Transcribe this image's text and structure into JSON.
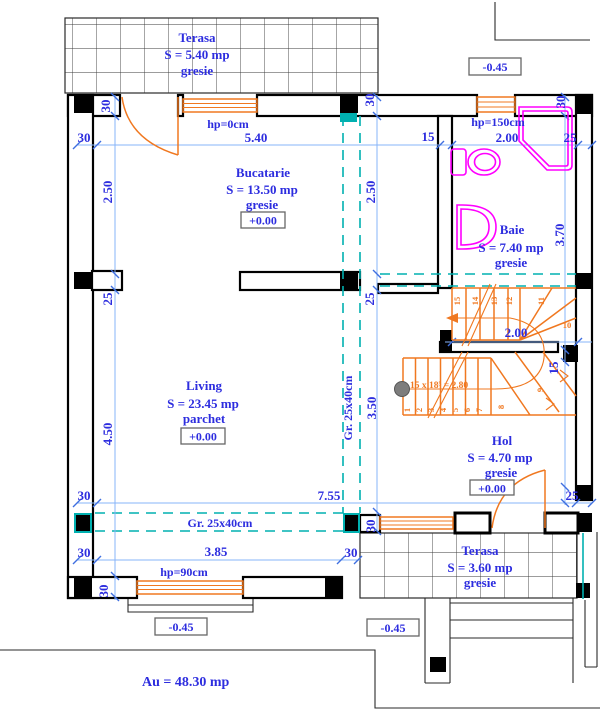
{
  "plan": {
    "rooms": {
      "terasa_top": {
        "name": "Terasa",
        "area": "S = 5.40 mp",
        "finish": "gresie"
      },
      "bucatarie": {
        "name": "Bucatarie",
        "area": "S = 13.50 mp",
        "finish": "gresie",
        "level": "+0.00"
      },
      "baie": {
        "name": "Baie",
        "area": "S = 7.40 mp",
        "finish": "gresie"
      },
      "living": {
        "name": "Living",
        "area": "S = 23.45 mp",
        "finish": "parchet",
        "level": "+0.00"
      },
      "hol": {
        "name": "Hol",
        "area": "S = 4.70 mp",
        "finish": "gresie",
        "level": "+0.00"
      },
      "terasa_bottom": {
        "name": "Terasa",
        "area": "S = 3.60 mp",
        "finish": "gresie"
      }
    },
    "levels": {
      "terrace_top_right": "-0.45",
      "terrace_bottom_left": "-0.45",
      "terrace_bottom_right": "-0.45"
    },
    "windows": {
      "kitchen": "hp=0cm",
      "bath": "hp=150cm",
      "living": "hp=90cm"
    },
    "beams": {
      "vertical": "Gr. 25x40cm",
      "horizontal": "Gr. 25x40cm"
    },
    "stairs": {
      "formula": "15 x 18⁵ = 2.80",
      "steps": [
        "1",
        "2",
        "3",
        "4",
        "5",
        "6",
        "7",
        "8",
        "9",
        "10",
        "11",
        "12",
        "13",
        "14",
        "15"
      ]
    },
    "total_area": "Au = 48.30 mp",
    "dimensions": {
      "top": [
        "30",
        "5.40",
        "15",
        "2.00",
        "25"
      ],
      "left": [
        "30",
        "2.50",
        "25",
        "4.50"
      ],
      "mid": [
        "30",
        "2.50",
        "25",
        "3.50",
        "30"
      ],
      "right": [
        "30",
        "3.70",
        "15"
      ],
      "stair": [
        "2.00"
      ],
      "bottom": [
        "30",
        "7.55",
        "25",
        "30",
        "3.85",
        "30",
        "30"
      ]
    },
    "colors": {
      "text_blue": "#2d2ddf",
      "dim_line": "#87b4f8",
      "beam_teal": "#00b0b0",
      "carpentry_orange": "#f07820",
      "fixture_magenta": "#ff00ff",
      "wall_black": "#000000"
    }
  }
}
